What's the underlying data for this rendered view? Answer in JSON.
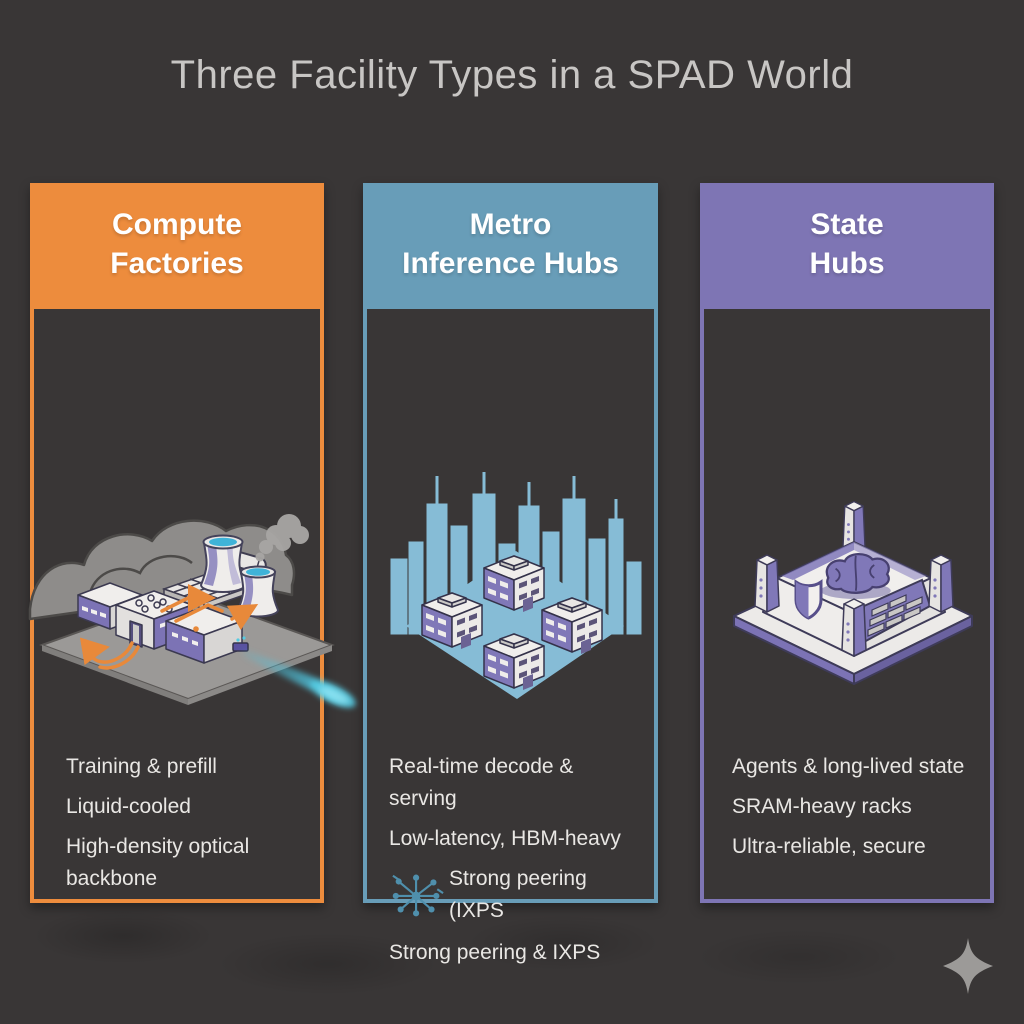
{
  "title": "Three Facility Types in a SPAD World",
  "colors": {
    "background": "#393636",
    "title_text": "#C8C6C4",
    "header_text": "#FFFFFF",
    "bullet_text": "#E9E7E4",
    "beam": "#55CBE2",
    "city_blue": "#86BCD6",
    "illustration_purple": "#7C73B5",
    "sparkle_gray": "#9C9A98"
  },
  "columns": [
    {
      "id": "compute-factories",
      "header_line1": "Compute",
      "header_line2": "Factories",
      "accent": "#ED8C3D",
      "bullets": [
        "Training & prefill",
        "Liquid-cooled",
        "High-density optical backbone"
      ]
    },
    {
      "id": "metro-inference-hubs",
      "header_line1": "Metro",
      "header_line2": "Inference Hubs",
      "accent": "#689DB8",
      "bullets": [
        "Real-time decode & serving",
        "Low-latency, HBM-heavy",
        "Strong peering (IXPS",
        "Strong peering & IXPS"
      ]
    },
    {
      "id": "state-hubs",
      "header_line1": "State",
      "header_line2": "Hubs",
      "accent": "#7E75B4",
      "bullets": [
        "Agents & long-lived state",
        "SRAM-heavy racks",
        "Ultra-reliable, secure"
      ]
    }
  ],
  "icons": {
    "network_hub": "hub-and-spoke network icon",
    "sparkle": "four-point sparkle"
  }
}
